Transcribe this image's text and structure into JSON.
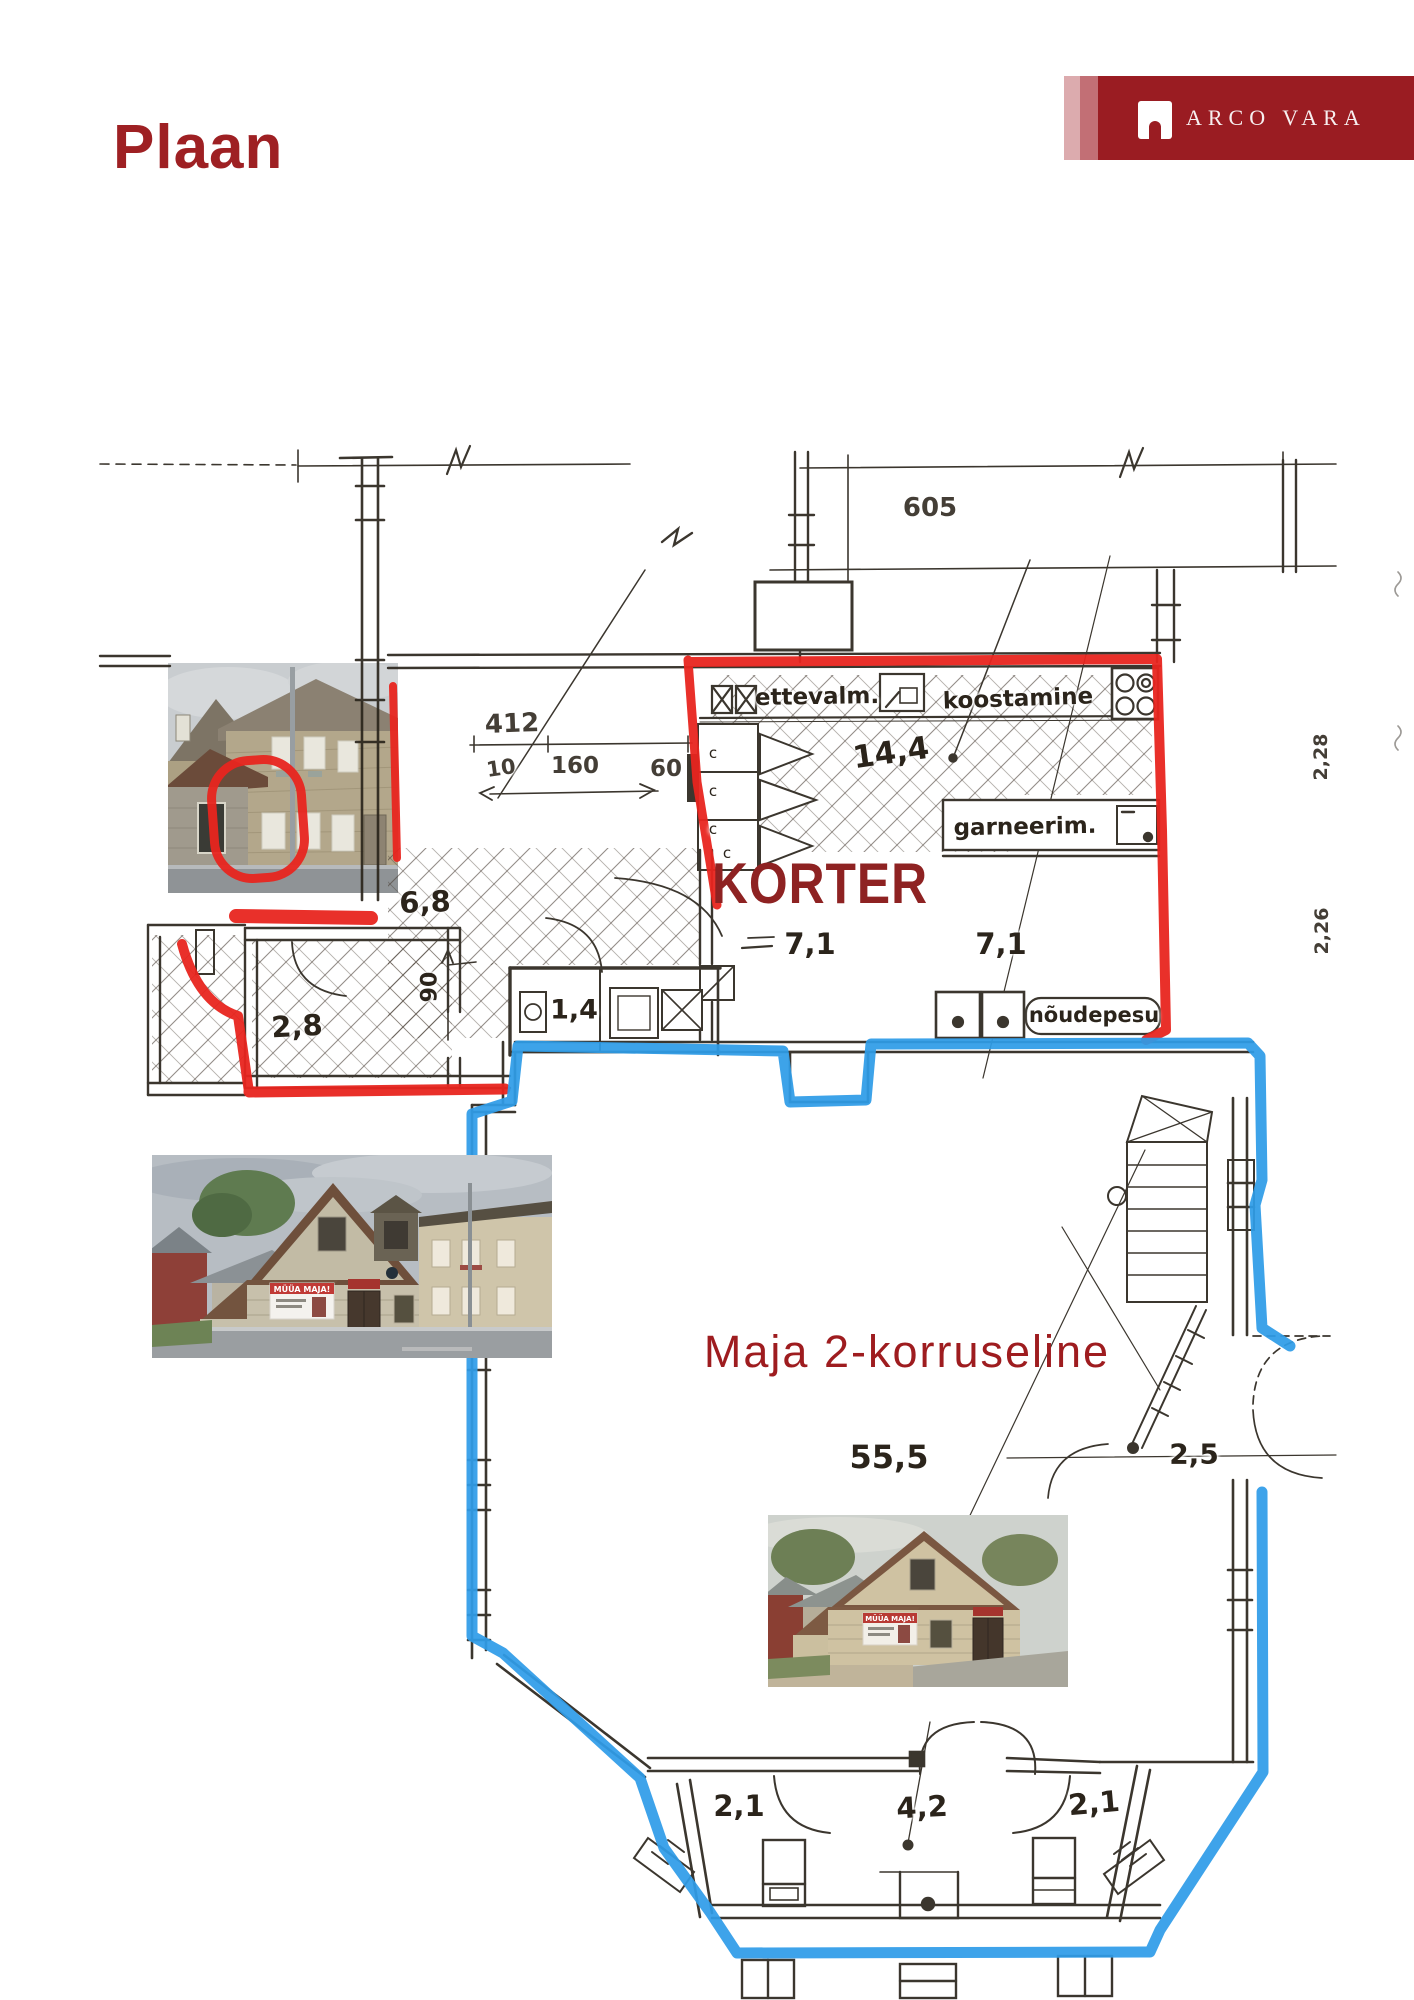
{
  "page": {
    "title": "Plaan"
  },
  "brand": {
    "name": "ARCO VARA",
    "logo_icon": "arch-door-icon"
  },
  "colors": {
    "title_red": "#9e2023",
    "banner_red": "#9a1c22",
    "banner_stripe_light": "#dcabae",
    "banner_stripe_mid": "#c26f75",
    "marker_apartment_red": "#e8251f",
    "marker_house_blue": "#2f9ce8",
    "korter_text": "#8e2222",
    "maja_text": "#9e1c1f",
    "sketch_ink": "#2b241b"
  },
  "plan": {
    "highlight_labels": {
      "korter": "KORTER",
      "maja": "Maja 2-korruseline"
    },
    "room_labels": {
      "ettevalm": "ettevalm.",
      "koostamine": "koostamine",
      "garneerim": "garneerim.",
      "noudepesu": "nõudepesu"
    },
    "dimensions": {
      "d605": "605",
      "d412": "412",
      "d10": "10",
      "d160": "160",
      "d60": "60",
      "a144": "14,4",
      "a68": "6,8",
      "a71a": "7,1",
      "a71b": "7,1",
      "a28": "2,8",
      "a14": "1,4",
      "d90": "90",
      "d228": "2,28",
      "d226": "2,26",
      "a555": "55,5",
      "d25": "2,5",
      "a21a": "2,1",
      "a42": "4,2",
      "a21b": "2,1"
    },
    "closet_marks": [
      "c",
      "c",
      "c",
      "c"
    ]
  },
  "photos": {
    "photo1": "two-storey wooden house, street view",
    "photo2": "stone corner building with sale banner, street view",
    "photo3": "stone corner building close-up",
    "banner_text": "MÜÜA MAJA!"
  }
}
